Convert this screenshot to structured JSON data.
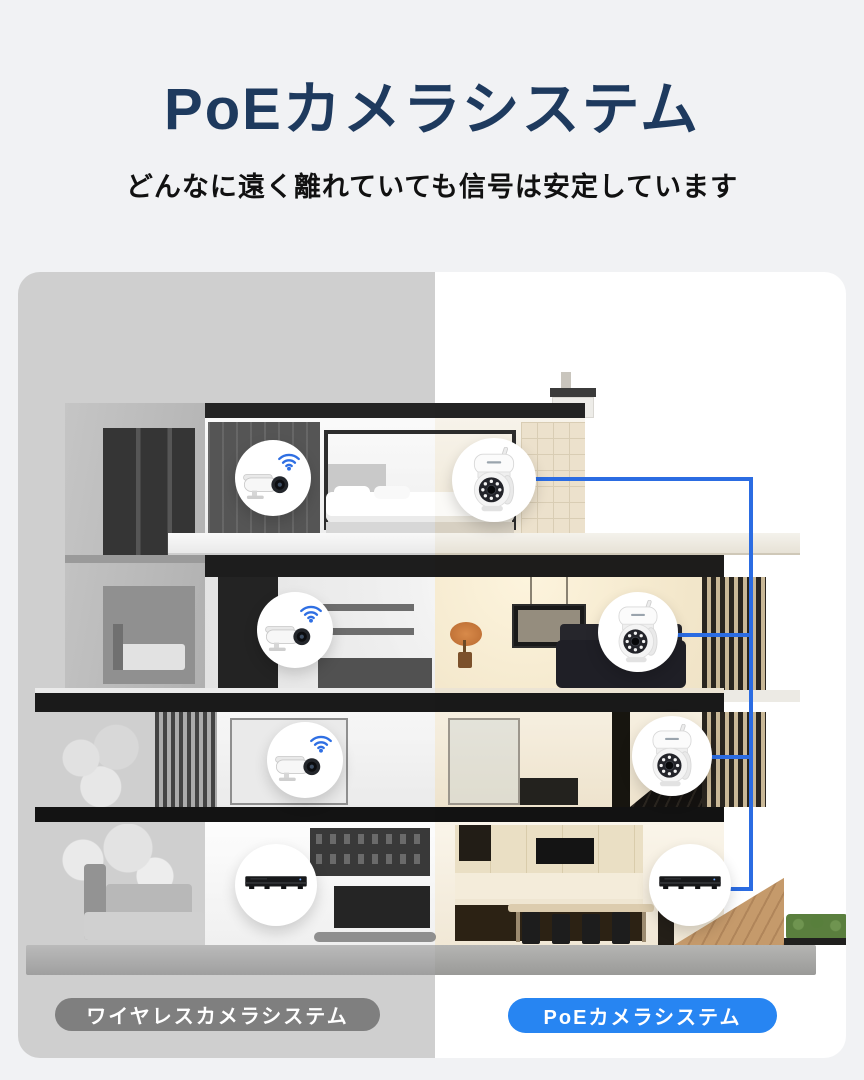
{
  "header": {
    "title": "PoEカメラシステム",
    "subtitle": "どんなに遠く離れていても信号は安定しています"
  },
  "scene": {
    "description_icon": "house-cross-section",
    "left_side": {
      "label": "ワイヤレスカメラシステム",
      "style": "grayscale",
      "pill_color": "#7f7f7f",
      "devices": [
        {
          "icon": "bullet-camera-icon",
          "signal_icon": "wifi-icon",
          "floor": 4
        },
        {
          "icon": "bullet-camera-icon",
          "signal_icon": "wifi-icon",
          "floor": 3
        },
        {
          "icon": "bullet-camera-icon",
          "signal_icon": "wifi-icon",
          "floor": 2
        },
        {
          "icon": "nvr-recorder-icon",
          "floor": 1
        }
      ]
    },
    "right_side": {
      "label": "PoEカメラシステム",
      "style": "color",
      "pill_color": "#2785f2",
      "cable_color": "#2b6ce2",
      "devices": [
        {
          "icon": "ptz-dome-camera-icon",
          "floor": 4,
          "wired": true
        },
        {
          "icon": "ptz-dome-camera-icon",
          "floor": 3,
          "wired": true
        },
        {
          "icon": "ptz-dome-camera-icon",
          "floor": 2,
          "wired": true
        },
        {
          "icon": "nvr-recorder-icon",
          "floor": 1,
          "wired": true
        }
      ]
    }
  },
  "colors": {
    "page_background": "#f1f2f4",
    "title": "#1e3a5e",
    "subtitle": "#111111",
    "pill_gray": "#7f7f7f",
    "pill_blue": "#2785f2",
    "cable_blue": "#2b6ce2",
    "wifi_blue": "#2f6fe3"
  }
}
